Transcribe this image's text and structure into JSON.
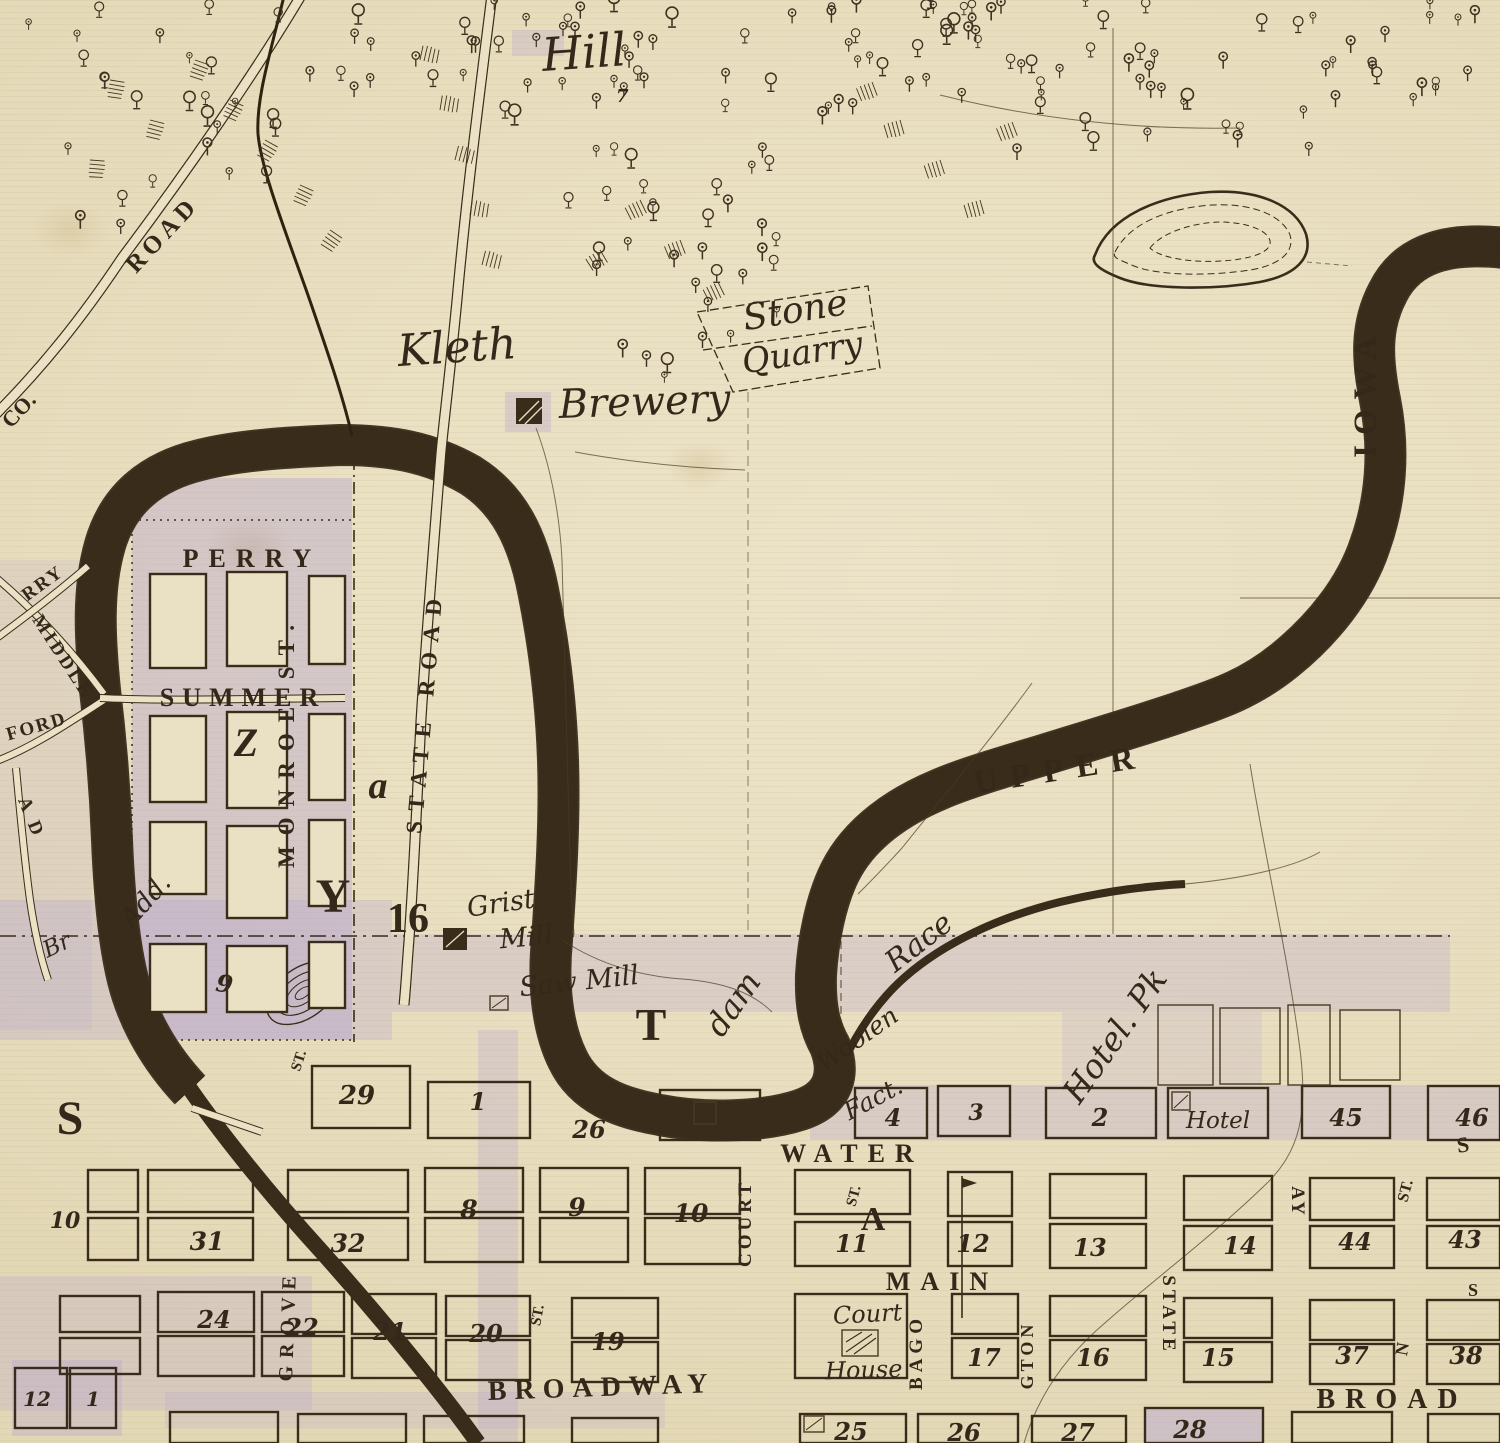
{
  "labels": {
    "hill": "Hill",
    "seven": "7",
    "co": "CO.",
    "road": "ROAD",
    "kleth": "Kleth",
    "brewery": "Brewery",
    "stone": "Stone",
    "quarry": "Quarry",
    "rry": "RRY",
    "middle": "MIDDLE",
    "ford": "FORD",
    "left_road_frag": "A D",
    "perry": "PERRY",
    "summer": "SUMMER",
    "monroe": "MONROE ST.",
    "state_road": "STATE ROAD",
    "upper": "UPPER",
    "iowa": "IOWA",
    "dam": "dam",
    "race": "Race",
    "grist": "Grist",
    "mill": "Mill",
    "sawmill": "Saw Mill",
    "woolen": "Woolen",
    "fact": "Fact.",
    "hotel_pk": "Hotel. Pk",
    "hotel_blk": "Hotel",
    "add": "Add.",
    "br": "Br",
    "water_st": "WATER",
    "main_st": "MAIN",
    "broadway": "BROADWAY",
    "broad": "BROAD",
    "court": "COURT",
    "court_st": "ST.",
    "bago": "BAGO",
    "gton": "GTON",
    "state_v": "STATE",
    "day": "AY",
    "grove": "GROVE",
    "st_right": "ST.",
    "st_mid": "ST.",
    "st_grove": "ST.",
    "n_frag": "N",
    "s_frag": "S",
    "s_frag2": "S",
    "court_house1": "Court",
    "court_house2": "House"
  },
  "letters": {
    "s": "S",
    "t": "T",
    "y": "Y",
    "z": "Z",
    "a_up": "A",
    "a_low": "a",
    "sixteen": "16"
  },
  "numbers": {
    "n9": "9",
    "n10": "10",
    "n29": "29",
    "n1x": "1",
    "n26": "26",
    "n12": "12",
    "n1": "1",
    "row_north": [
      "4",
      "3",
      "2",
      "45",
      "46"
    ],
    "row_a": [
      "8",
      "9",
      "10",
      "11",
      "12",
      "13",
      "14",
      "44",
      "43"
    ],
    "row_left": [
      "31",
      "32"
    ],
    "row_left2": [
      "24",
      "22",
      "21",
      "20",
      "19"
    ],
    "row_b": [
      "17",
      "16",
      "15",
      "37",
      "38"
    ],
    "row_c": [
      "25",
      "26",
      "27",
      "28"
    ]
  },
  "colors": {
    "ink": "#3a2c1a",
    "paper": "#e9dfc0",
    "tint": "#b4a3d0"
  }
}
